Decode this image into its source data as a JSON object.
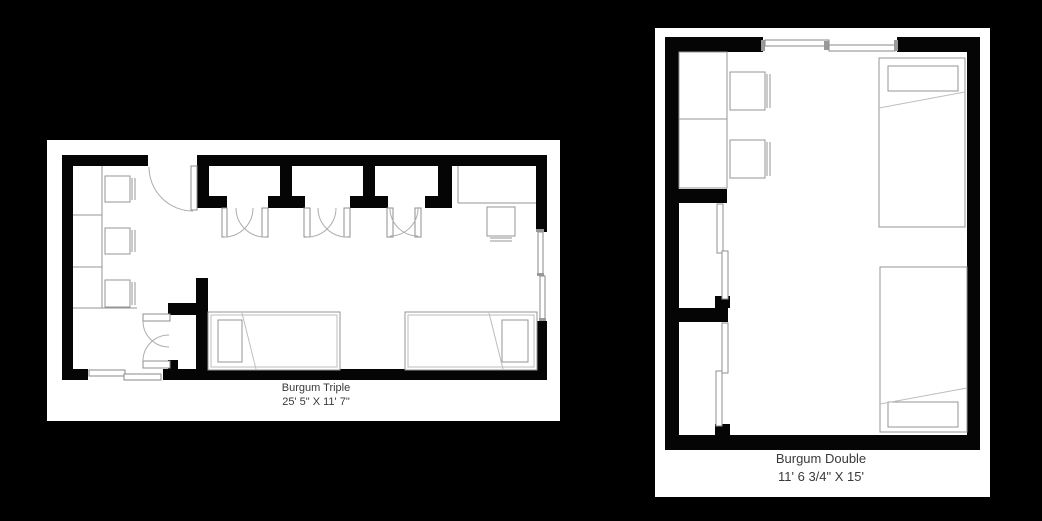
{
  "canvas": {
    "background_color": "#000000",
    "paper_color": "#ffffff",
    "wall_color": "#050505",
    "furniture_line_color": "#949494",
    "text_color": "#3a3a3a"
  },
  "plans": [
    {
      "id": "burgum-triple",
      "title": "Burgum Triple",
      "dimensions": "25' 5\" X 11' 7\"",
      "features": [
        "entry-door",
        "three-closet-bays",
        "three-desks-with-chairs",
        "corner-desk-with-chair",
        "double-door-closet",
        "two-beds",
        "two-windows"
      ]
    },
    {
      "id": "burgum-double",
      "title": "Burgum Double",
      "dimensions": "11' 6 3/4\" X 15'",
      "features": [
        "two-desks-with-chairs",
        "two-sliding-door-closets",
        "two-beds",
        "window"
      ]
    }
  ]
}
